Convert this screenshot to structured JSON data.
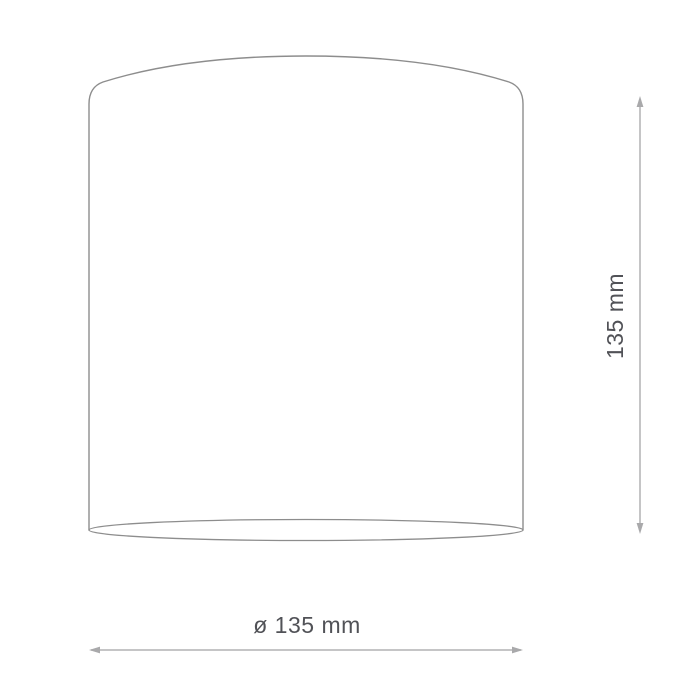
{
  "figure": {
    "type": "product-dimension-diagram",
    "labels": {
      "diameter": "ø 135 mm",
      "height": "135 mm"
    },
    "colors": {
      "background": "#ffffff",
      "outline": "#8d8d8d",
      "dimension_line": "#b2b2b4",
      "arrow": "#a9a9ab",
      "label_text": "#515257"
    }
  }
}
